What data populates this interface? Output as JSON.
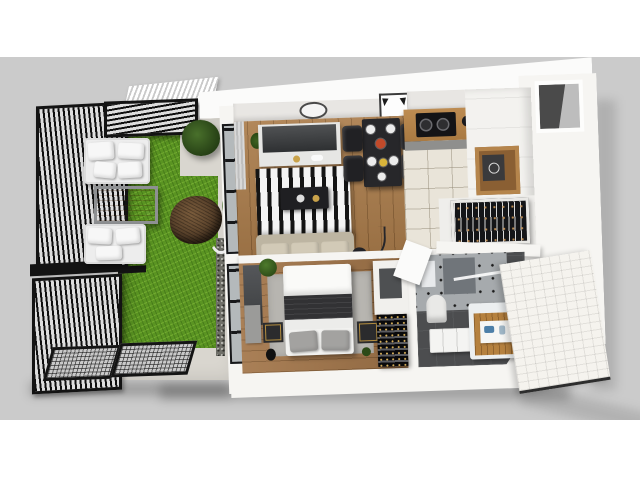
{
  "scene": {
    "kind": "3d-rendered-apartment-floor-plan",
    "view": "top-down cutaway with slight perspective",
    "background_color": "#cbcbcb",
    "letterbox": {
      "color": "#ffffff",
      "top_band_px": 57,
      "bottom_band_px": 60
    }
  },
  "palette": {
    "grass": "#5a9422",
    "concrete_path": "#d9d6cf",
    "gravel": "#6f6f68",
    "fence_black": "#131313",
    "fence_slat_light": "#dedede",
    "outer_wall_white": "#f6f5f2",
    "interior_wall_gray": "#e8e6e3",
    "wood_floor": "#a87c4b",
    "kitchen_tile": "#e9e4d9",
    "rug_black": "#141414",
    "rug_white": "#f4f4f4",
    "sofa_beige": "#cdc5b2",
    "dining_table_black": "#27272a",
    "counter_wood": "#b5854c",
    "bath_floor_dark": "#4c4d4f",
    "bath_tile_gray": "#a6aaad",
    "bath_tile_white": "#f5f3ee",
    "bath_wood_panel": "#b5813f",
    "bed_blanket_dark": "#323234",
    "egg_chair_brown": "#57402a",
    "gold_accent": "#c9a24a"
  },
  "terrace": {
    "name": "terrace-garden",
    "features": [
      "black-louvered-fence-left",
      "black-louvered-fence-top",
      "white-pergola-awning",
      "grass-lawn",
      "concrete-path",
      "gravel-drainage-strip",
      "white-outdoor-sofa-upper",
      "white-outdoor-sofa-lower",
      "wooden-coffee-table",
      "hanging-egg-chair",
      "tree-in-planter",
      "shrubs-by-wall",
      "deck-grate-panels-bottom"
    ]
  },
  "rooms": [
    {
      "id": "living-room",
      "floor": "wood-planks-vertical",
      "items": [
        "wall-clock",
        "butterfly-picture",
        "media-sideboard-with-tv",
        "curtain",
        "black-white-striped-rug",
        "black-coffee-table",
        "gold-bowl",
        "beige-three-seat-sofa",
        "arc-floor-lamp",
        "potted-plant"
      ]
    },
    {
      "id": "dining-area",
      "floor": "wood-planks-vertical",
      "items": [
        "black-dining-table",
        "four-black-chairs",
        "place-settings-white-plates",
        "red-dish",
        "yellow-dish"
      ]
    },
    {
      "id": "kitchen",
      "floor": "beige-tile",
      "items": [
        "wooden-countertop",
        "black-cooktop-two-burners",
        "black-kettle",
        "shadowed-base-cabinets",
        "tall-white-cabinet-wall",
        "built-in-oven-in-wood-niche"
      ]
    },
    {
      "id": "hallway",
      "floor": "light",
      "items": [
        "entrance-niche",
        "open-wardrobe-with-hanging-clothes",
        "white-console-shelf"
      ]
    },
    {
      "id": "bedroom",
      "floor": "wood-planks-horizontal",
      "items": [
        "double-bed-white-duvet-dark-throw",
        "two-gray-pillows",
        "gray-area-rug",
        "black-nightstands-gold-trim",
        "wardrobe-tv-panel",
        "gray-dresser",
        "white-media-column-with-screen",
        "wine-rack-shelf",
        "corner-plant",
        "black-vase",
        "terrace-glass-door"
      ]
    },
    {
      "id": "bathroom",
      "floor": "dark-gray-tile",
      "items": [
        "open-white-door",
        "wall-hung-toilet",
        "mirror",
        "gray-dotted-tile-wall",
        "dark-shower-panel",
        "glass-shower-screen",
        "white-vanity-cabinet",
        "bathtub-with-wood-panel",
        "white-bath-tray",
        "blue-toiletries",
        "white-subway-tile-wall"
      ]
    }
  ]
}
